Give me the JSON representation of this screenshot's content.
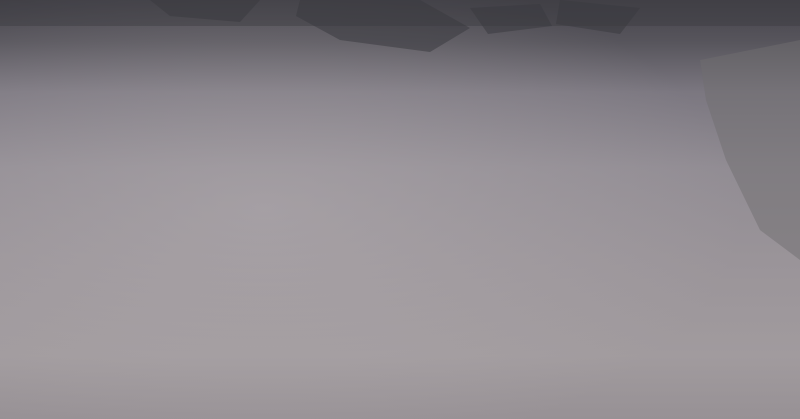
{
  "scene": {
    "width": 800,
    "height": 419,
    "kind": "aerial-city-masterplan-rendering"
  },
  "palette": {
    "groundStops": [
      [
        "0",
        "#45434b"
      ],
      [
        "0.10",
        "#57555c"
      ],
      [
        "0.22",
        "#7b7780"
      ],
      [
        "0.40",
        "#918c93"
      ],
      [
        "0.62",
        "#9a9499"
      ],
      [
        "0.85",
        "#a19b9e"
      ],
      [
        "1",
        "#979195"
      ]
    ],
    "horizonBand": "#3c3b41",
    "patch": "#3b3a40",
    "distant": "#7b787e",
    "building": "#ebebee",
    "buildingDim": "#d7d7dc",
    "shadow": "rgba(42,41,53,0.5)",
    "roadMajor": "#a3a0a8",
    "roadCenter": "#d2cfd6",
    "roadMinor": "#b9b6bd",
    "forestBase": "#31482c",
    "forestDots": [
      "#26401f",
      "#375930",
      "#456a34",
      "#52783b",
      "#2c4d26"
    ],
    "parkBand": "#3f5c31",
    "parkBand2": "#4a6b38",
    "autumn": [
      "#b35c2c",
      "#cc8038",
      "#9e4c26",
      "#d89a4a"
    ],
    "riverTeal": "#6fb2ae",
    "riverLight": "#9ad1cb",
    "lakeTeal": "#7cc2c6",
    "beach": "#d8d1b4",
    "wetland": "#46565c",
    "wetlandEdge": "#5d8b84",
    "bigRiver": "#7e8d8c",
    "bigRiverEdge": "#6d7c7c",
    "runway": "#b8b5bb",
    "runway2": "#908d93",
    "farmland": "#6f6e70",
    "cloud": "#dcdde2",
    "cloudBright": "#eaebef",
    "bird": "#f2f3f6",
    "roundGreen": "#4e6b3f",
    "civic": [
      "#565b63",
      "#6a707a",
      "#494d55"
    ],
    "plaza": "#b3ada6",
    "stadium": "#e9e9ec",
    "stadiumInner": "#c9ccd2",
    "trackGreen": "#4a7a39",
    "trackRing": "#b35a3c",
    "pink": "#d9c3c9",
    "shedTeal": "#7fb4ae",
    "boat": "#d3dada",
    "trail": "#c4703a"
  },
  "darkPatches": [
    [
      [
        300,
        0
      ],
      [
        420,
        0
      ],
      [
        470,
        28
      ],
      [
        430,
        52
      ],
      [
        340,
        40
      ],
      [
        296,
        16
      ]
    ],
    [
      [
        150,
        0
      ],
      [
        260,
        0
      ],
      [
        240,
        22
      ],
      [
        170,
        16
      ]
    ],
    [
      [
        560,
        0
      ],
      [
        640,
        8
      ],
      [
        620,
        34
      ],
      [
        556,
        24
      ]
    ],
    [
      [
        470,
        8
      ],
      [
        540,
        4
      ],
      [
        552,
        26
      ],
      [
        488,
        34
      ]
    ]
  ],
  "distantBlocks": {
    "count": 95,
    "x": 0,
    "y": 3,
    "w": 790,
    "h": 52
  },
  "farmland": {
    "pts": [
      [
        700,
        60
      ],
      [
        800,
        40
      ],
      [
        800,
        260
      ],
      [
        760,
        230
      ],
      [
        726,
        160
      ],
      [
        706,
        100
      ]
    ],
    "opacity": 0.5
  },
  "minorRoads": [
    [
      -10,
      255,
      420,
      75
    ],
    [
      0,
      345,
      470,
      140
    ],
    [
      20,
      190,
      300,
      62
    ],
    [
      150,
      130,
      420,
      20
    ],
    [
      90,
      90,
      260,
      20
    ],
    [
      420,
      300,
      640,
      180
    ],
    [
      470,
      345,
      700,
      215
    ],
    [
      180,
      300,
      420,
      190
    ],
    [
      60,
      140,
      200,
      80
    ],
    [
      400,
      298,
      620,
      168
    ],
    [
      60,
      0,
      560,
      215
    ],
    [
      0,
      36,
      470,
      230
    ],
    [
      0,
      88,
      360,
      240
    ],
    [
      120,
      0,
      660,
      230
    ],
    [
      210,
      0,
      740,
      215
    ],
    [
      350,
      0,
      790,
      180
    ],
    [
      430,
      0,
      800,
      140
    ],
    [
      0,
      170,
      240,
      280
    ],
    [
      500,
      0,
      800,
      108
    ],
    [
      40,
      0,
      340,
      130
    ],
    [
      380,
      205,
      640,
      310
    ]
  ],
  "majorRoads": [
    {
      "d": "M-20,290 L680,30",
      "w": 3.2,
      "dash": true,
      "trees": [
        0,
        0.35
      ]
    },
    {
      "d": "M76,419 L566,85",
      "w": 3.0,
      "dash": true,
      "trees": [
        0,
        0.28
      ]
    },
    {
      "d": "M258,412 L610,158",
      "w": 3.0,
      "dash": true,
      "trees": [
        0,
        0.45
      ]
    },
    {
      "d": "M662,125 C648,165 638,196 632,218 C624,248 616,300 610,360 L608,419",
      "w": 3.4,
      "dash": true
    },
    {
      "d": "M142,8 L700,238",
      "w": 2.6
    },
    {
      "d": "M30,128 L700,398",
      "w": 3.0,
      "dash": true,
      "trees": [
        0.58,
        0.95
      ]
    },
    {
      "d": "M300,26 L760,226",
      "w": 2.8
    },
    {
      "d": "M148,38 C260,62 340,80 420,98 C470,110 520,128 560,142",
      "w": 2.4
    },
    {
      "d": "M303,162 C310,192 314,220 320,248",
      "w": 2.0
    }
  ],
  "bigRiver": {
    "dTop": "M652,-6 C664,24 678,58 695,90 C702,104 706,118 707,130",
    "wTop": 27,
    "dMain": "M707,128 C706,160 700,190 700,215 C700,246 716,278 735,305 C754,332 772,360 790,390 L805,419",
    "wMain": 48
  },
  "riverWakes": [
    [
      648,
      40
    ],
    [
      668,
      84
    ],
    [
      700,
      150
    ],
    [
      702,
      196
    ],
    [
      716,
      262
    ],
    [
      744,
      310
    ]
  ],
  "runway": {
    "x": 707,
    "y": 8,
    "angle": 28,
    "len": 100,
    "w": 7
  },
  "lake": {
    "pts": [
      [
        95,
        38
      ],
      [
        150,
        32
      ],
      [
        200,
        36
      ],
      [
        211,
        58
      ],
      [
        186,
        74
      ],
      [
        118,
        72
      ],
      [
        88,
        56
      ]
    ]
  },
  "corridor": {
    "main": "M205,58 C245,70 272,84 290,100 C306,117 312,128 324,141 C340,158 356,149 372,163 C392,180 386,204 378,218 C370,232 372,244 384,256 C396,268 406,276 411,291",
    "bend": [
      [
        330,
        140
      ],
      [
        398,
        150
      ],
      [
        406,
        200
      ],
      [
        396,
        248
      ],
      [
        360,
        236
      ],
      [
        334,
        190
      ]
    ],
    "swirls": [
      "M342,158 C366,168 386,186 380,212 C376,232 362,236 352,224",
      "M352,146 C374,150 392,168 390,196"
    ],
    "stream": "M250,52 C246,80 250,104 260,128 C266,142 274,152 288,162",
    "canal": "M212,58 C250,68 290,80 330,92"
  },
  "wetland": {
    "pts": [
      [
        268,
        302
      ],
      [
        320,
        286
      ],
      [
        380,
        290
      ],
      [
        440,
        300
      ],
      [
        505,
        315
      ],
      [
        560,
        332
      ],
      [
        596,
        356
      ],
      [
        570,
        392
      ],
      [
        510,
        412
      ],
      [
        430,
        419
      ],
      [
        300,
        419
      ],
      [
        252,
        372
      ],
      [
        248,
        332
      ]
    ],
    "islands": [
      [
        [
          262,
          318
        ],
        [
          300,
          300
        ],
        [
          330,
          306
        ],
        [
          340,
          330
        ],
        [
          318,
          352
        ],
        [
          282,
          344
        ]
      ],
      [
        [
          352,
          322
        ],
        [
          392,
          312
        ],
        [
          420,
          322
        ],
        [
          430,
          342
        ],
        [
          400,
          356
        ],
        [
          362,
          344
        ]
      ],
      [
        [
          446,
          310
        ],
        [
          520,
          322
        ],
        [
          560,
          338
        ],
        [
          540,
          356
        ],
        [
          488,
          346
        ],
        [
          450,
          328
        ]
      ],
      [
        [
          330,
          368
        ],
        [
          360,
          360
        ],
        [
          376,
          372
        ],
        [
          352,
          382
        ]
      ]
    ],
    "boats": [
      [
        452,
        352
      ],
      [
        492,
        368
      ],
      [
        540,
        374
      ],
      [
        576,
        352
      ],
      [
        612,
        344
      ],
      [
        430,
        330
      ]
    ]
  },
  "forests": [
    {
      "pts": [
        [
          618,
          175
        ],
        [
          668,
          190
        ],
        [
          700,
          250
        ],
        [
          708,
          312
        ],
        [
          660,
          346
        ],
        [
          600,
          332
        ],
        [
          586,
          262
        ],
        [
          596,
          205
        ]
      ],
      "dots": 120
    },
    {
      "pts": [
        [
          462,
          140
        ],
        [
          540,
          118
        ],
        [
          566,
          148
        ],
        [
          506,
          172
        ],
        [
          470,
          162
        ]
      ],
      "dots": 45
    },
    {
      "pts": [
        [
          556,
          298
        ],
        [
          644,
          290
        ],
        [
          678,
          324
        ],
        [
          642,
          356
        ],
        [
          580,
          344
        ],
        [
          552,
          322
        ]
      ],
      "dots": 70
    },
    {
      "pts": [
        [
          150,
          296
        ],
        [
          252,
          282
        ],
        [
          262,
          330
        ],
        [
          256,
          386
        ],
        [
          208,
          419
        ],
        [
          140,
          419
        ],
        [
          128,
          352
        ]
      ],
      "dots": 110
    },
    {
      "pts": [
        [
          214,
          40
        ],
        [
          300,
          62
        ],
        [
          360,
          84
        ],
        [
          352,
          98
        ],
        [
          288,
          80
        ],
        [
          208,
          56
        ]
      ],
      "dots": 45
    }
  ],
  "orangeTrails": [
    "M272,334 C286,312 302,300 324,296",
    "M268,336 C264,356 280,364 300,360",
    "M530,332 C572,342 614,338 654,322 C686,308 708,294 724,286",
    "M560,300 C600,290 636,290 662,298"
  ],
  "clusters": [
    {
      "x": 100,
      "y": 16,
      "w": 130,
      "h": 26,
      "rows": 2,
      "cols": 8,
      "bw": 8,
      "bh": 6,
      "a": -8,
      "den": 0.8,
      "tall": 0,
      "op": 0.85
    },
    {
      "x": 52,
      "y": 52,
      "w": 80,
      "h": 72,
      "rows": 4,
      "cols": 4,
      "bw": 9,
      "bh": 7,
      "a": -14,
      "den": 0.8,
      "tall": 0,
      "op": 0.95
    },
    {
      "x": 140,
      "y": 80,
      "w": 115,
      "h": 56,
      "rows": 3,
      "cols": 5,
      "bw": 10,
      "bh": 8,
      "a": -16,
      "den": 0.85,
      "tall": 0.2,
      "op": 1
    },
    {
      "x": 238,
      "y": 28,
      "w": 190,
      "h": 44,
      "rows": 3,
      "cols": 10,
      "bw": 8,
      "bh": 6,
      "a": -10,
      "den": 0.75,
      "tall": 0,
      "op": 0.9
    },
    {
      "x": 92,
      "y": 128,
      "w": 240,
      "h": 96,
      "rows": 5,
      "cols": 10,
      "bw": 10,
      "bh": 8,
      "a": -18,
      "den": 0.8,
      "tall": 0.12,
      "op": 1
    },
    {
      "x": 352,
      "y": 72,
      "w": 180,
      "h": 66,
      "rows": 3,
      "cols": 8,
      "bw": 9,
      "bh": 7,
      "a": -14,
      "den": 0.8,
      "tall": 0,
      "op": 1
    },
    {
      "x": 428,
      "y": 148,
      "w": 210,
      "h": 124,
      "rows": 6,
      "cols": 9,
      "bw": 10,
      "bh": 8,
      "a": -18,
      "den": 0.82,
      "tall": 0.08,
      "op": 1
    },
    {
      "x": 8,
      "y": 192,
      "w": 92,
      "h": 70,
      "rows": 4,
      "cols": 4,
      "bw": 9,
      "bh": 6,
      "a": -18,
      "den": 0.7,
      "tall": 0,
      "op": 0.4
    },
    {
      "x": 52,
      "y": 248,
      "w": 112,
      "h": 54,
      "rows": 3,
      "cols": 5,
      "bw": 11,
      "bh": 6,
      "a": -20,
      "den": 0.75,
      "tall": 0,
      "op": 0.7
    },
    {
      "x": 92,
      "y": 276,
      "w": 112,
      "h": 36,
      "rows": 3,
      "cols": 4,
      "bw": 16,
      "bh": 6,
      "a": -18,
      "den": 0.85,
      "tall": 0,
      "op": 0.95,
      "roofs": [
        "#ebebee",
        "#7fb4ae",
        "#cfd3d4"
      ]
    },
    {
      "x": 232,
      "y": 182,
      "w": 78,
      "h": 84,
      "rows": 4,
      "cols": 4,
      "bw": 9,
      "bh": 7,
      "a": -20,
      "den": 0.8,
      "tall": 0,
      "op": 1
    },
    {
      "x": 436,
      "y": 36,
      "w": 120,
      "h": 32,
      "rows": 2,
      "cols": 7,
      "bw": 7,
      "bh": 5,
      "a": -10,
      "den": 0.7,
      "tall": 0,
      "op": 0.75
    },
    {
      "x": 560,
      "y": 122,
      "w": 95,
      "h": 48,
      "rows": 3,
      "cols": 5,
      "bw": 9,
      "bh": 6,
      "a": -8,
      "den": 0.6,
      "tall": 0,
      "op": 0.45
    }
  ],
  "landmarks": {
    "stadium": {
      "cx": 279,
      "cy": 85,
      "rx": 14.5,
      "ry": 8
    },
    "track": {
      "x": 286,
      "y": 96,
      "w": 28,
      "h": 15,
      "a": -16
    },
    "ovalPark": {
      "cx": 209,
      "cy": 146,
      "rx": 11,
      "ry": 5,
      "a": -14
    },
    "pinkHall": {
      "x": 162,
      "y": 145,
      "a": -14
    },
    "civic": {
      "cx": 408,
      "cy": 160,
      "a": -16
    }
  },
  "roundabouts": [
    [
      305,
      168,
      5
    ],
    [
      318,
      246,
      6
    ],
    [
      416,
      296,
      7
    ],
    [
      479,
      250,
      4.5
    ],
    [
      568,
      157,
      4
    ]
  ],
  "clouds": [
    {
      "x": 28,
      "y": 60,
      "rx": 60,
      "ry": 45,
      "o": 0.5,
      "b": 2
    },
    {
      "x": 70,
      "y": 105,
      "rx": 55,
      "ry": 35,
      "o": 0.4,
      "b": 2
    },
    {
      "x": 22,
      "y": 170,
      "rx": 75,
      "ry": 60,
      "o": 0.55,
      "b": 2
    },
    {
      "x": 40,
      "y": 250,
      "rx": 85,
      "ry": 60,
      "o": 0.6,
      "b": 2
    },
    {
      "x": 18,
      "y": 335,
      "rx": 95,
      "ry": 70,
      "o": 0.6,
      "b": 2
    },
    {
      "x": 95,
      "y": 300,
      "rx": 70,
      "ry": 45,
      "o": 0.45,
      "b": 2
    },
    {
      "x": 150,
      "y": 345,
      "rx": 85,
      "ry": 45,
      "o": 0.4,
      "b": 2
    },
    {
      "x": 265,
      "y": 390,
      "rx": 95,
      "ry": 40,
      "o": 0.45,
      "b": 2
    },
    {
      "x": 385,
      "y": 408,
      "rx": 100,
      "ry": 35,
      "o": 0.5,
      "b": 2
    },
    {
      "x": 620,
      "y": 400,
      "rx": 85,
      "ry": 38,
      "o": 0.55,
      "b": 2
    },
    {
      "x": 705,
      "y": 335,
      "rx": 85,
      "ry": 55,
      "o": 0.65,
      "b": 2
    },
    {
      "x": 762,
      "y": 300,
      "rx": 70,
      "ry": 50,
      "o": 0.6,
      "b": 2
    },
    {
      "x": 780,
      "y": 398,
      "rx": 95,
      "ry": 45,
      "o": 0.72,
      "b": 2,
      "bright": 1
    },
    {
      "x": 745,
      "y": 250,
      "rx": 60,
      "ry": 40,
      "o": 0.5,
      "b": 2
    },
    {
      "x": 795,
      "y": 215,
      "rx": 55,
      "ry": 35,
      "o": 0.4,
      "b": 2
    },
    {
      "x": 350,
      "y": 12,
      "rx": 85,
      "ry": 25,
      "o": 0.3,
      "b": 2
    },
    {
      "x": 480,
      "y": 22,
      "rx": 75,
      "ry": 22,
      "o": 0.28,
      "b": 2
    },
    {
      "x": 252,
      "y": 6,
      "rx": 65,
      "ry": 20,
      "o": 0.28,
      "b": 2
    },
    {
      "x": 655,
      "y": 8,
      "rx": 70,
      "ry": 22,
      "o": 0.3,
      "b": 2
    },
    {
      "x": 590,
      "y": 368,
      "rx": 70,
      "ry": 30,
      "o": 0.45,
      "b": 2
    },
    {
      "x": 112,
      "y": 38,
      "rx": 40,
      "ry": 26,
      "o": 0.38,
      "b": 1
    },
    {
      "x": 178,
      "y": 328,
      "rx": 50,
      "ry": 26,
      "o": 0.3,
      "b": 1
    },
    {
      "x": 730,
      "y": 180,
      "rx": 45,
      "ry": 28,
      "o": 0.3,
      "b": 1
    },
    {
      "x": 60,
      "y": 390,
      "rx": 90,
      "ry": 35,
      "o": 0.5,
      "b": 2
    }
  ],
  "birds": {
    "left": [
      [
        67,
        317,
        5
      ],
      [
        78,
        323,
        4
      ],
      [
        88,
        315,
        5
      ],
      [
        97,
        331,
        4
      ],
      [
        72,
        333,
        4
      ],
      [
        112,
        347,
        4
      ],
      [
        118,
        351,
        3
      ],
      [
        186,
        322,
        13
      ],
      [
        224,
        350,
        4
      ],
      [
        140,
        338,
        3
      ]
    ],
    "right": [
      [
        478,
        380,
        4
      ],
      [
        492,
        372,
        4
      ],
      [
        506,
        390,
        4
      ],
      [
        522,
        401,
        4
      ],
      [
        541,
        394,
        4
      ],
      [
        557,
        406,
        4
      ],
      [
        568,
        391,
        3
      ],
      [
        547,
        379,
        3
      ],
      [
        578,
        398,
        4
      ],
      [
        560,
        412,
        3
      ],
      [
        536,
        415,
        3
      ]
    ]
  }
}
